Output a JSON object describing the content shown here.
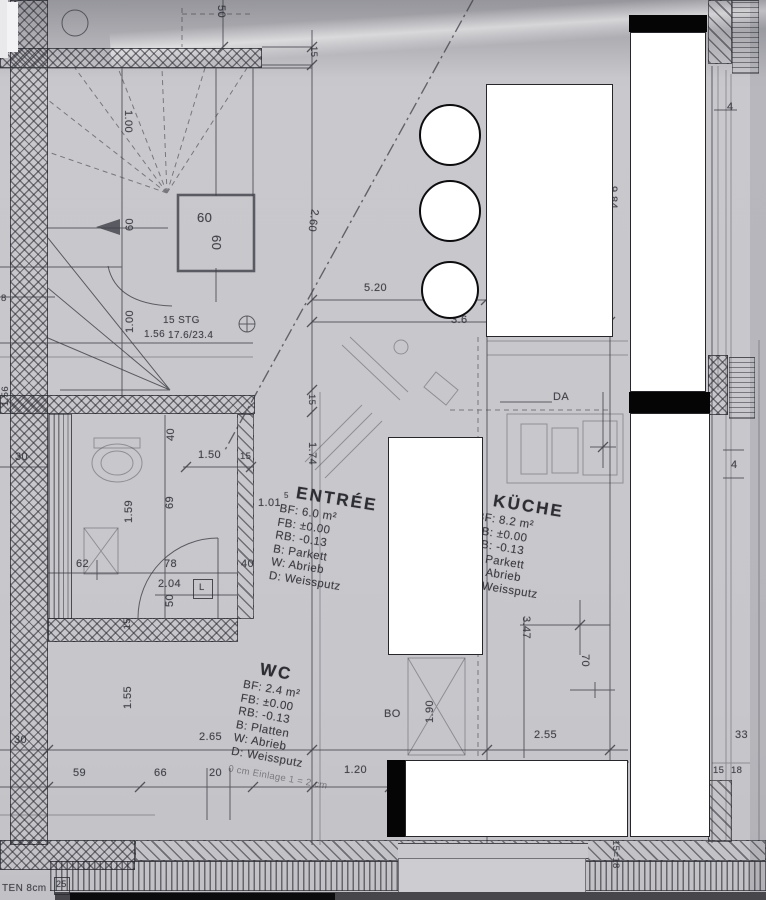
{
  "colors": {
    "paper": "#c7c7cb",
    "ink": "#3c3c44",
    "redaction_fill": "#ffffff",
    "redaction_border": "#26262b",
    "black_bar": "#050506"
  },
  "rooms": {
    "entree": {
      "name": "ENTRÉE",
      "lines": [
        "BF: 6.0 m²",
        "FB: ±0.00",
        "RB: -0.13",
        "B: Parkett",
        "W: Abrieb",
        "D: Weissputz"
      ]
    },
    "kueche": {
      "name": "KÜCHE",
      "lines": [
        "BF: 8.2 m²",
        "FB: ±0.00",
        "RB: -0.13",
        "B: Parkett",
        "W: Abrieb",
        "D: Weissputz"
      ]
    },
    "wc": {
      "name": "WC",
      "lines": [
        "BF: 2.4 m²",
        "FB: ±0.00",
        "RB: -0.13",
        "B: Platten",
        "W: Abrieb",
        "D: Weissputz"
      ],
      "note": "0 cm Einlage 1 = 2 cm"
    }
  },
  "stairs": {
    "note_1": "15 STG",
    "note_2": "1.56",
    "note_3": "17.6/23.4"
  },
  "dims": {
    "top_50": "50",
    "top_15": "15",
    "left_8": "8",
    "left_156": "1.56",
    "stair_100_upper": "1.00",
    "stair_100_lower": "1.00",
    "stair_60_box_h": "60",
    "stair_60_box_v": "60",
    "stair_60_width": "60",
    "diag_260": "2.60",
    "dim_520": "5.20",
    "dim_36": "3.6",
    "right_984": "9.84",
    "right_4_top": "4",
    "right_4_mid": "4",
    "wc_30": "30",
    "wc_150": "1.50",
    "wc_15_right": "15",
    "wc_40_left": "40",
    "wc_159": "1.59",
    "wc_69": "69",
    "wc_62": "62",
    "wc_78": "78",
    "wc_204": "2.04",
    "wc_50": "50",
    "wc_40_right": "40",
    "wc_15_bottom": "15",
    "ent_101": "1.01",
    "ent_101_sup": "5",
    "mid_15": "15",
    "mid_174": "1.74",
    "low_155": "1.55",
    "low_30": "30",
    "low_265": "2.65",
    "low_59": "59",
    "low_66": "66",
    "low_20": "20",
    "low_120": "1.20",
    "kit_347": "3.47",
    "kit_70": "70",
    "kit_190": "1.90",
    "kit_255": "2.55",
    "right_33": "33",
    "right_15": "15",
    "right_18": "18",
    "bottom_1518": "15=18"
  },
  "annotations": {
    "da": "DA",
    "bo": "BO",
    "door_l": "L",
    "edge_text": "TEN 8cm",
    "edge_25": "25"
  }
}
